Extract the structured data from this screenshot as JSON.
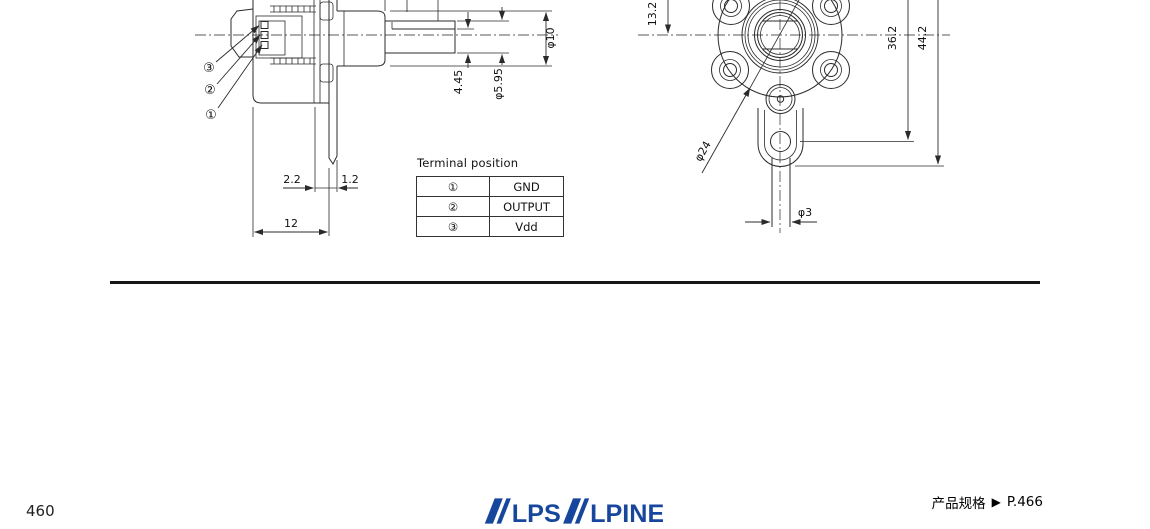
{
  "page": {
    "page_number": "460",
    "footer_right": {
      "label": "产品规格",
      "arrow": "▶",
      "page_ref": "P.466"
    },
    "brand": {
      "logo_text": "ALPSALPINE",
      "logo_color": "#17479d",
      "logo_part_lps": "LPS",
      "logo_part_lpine": "LPINE"
    }
  },
  "terminal_table": {
    "title": "Terminal position",
    "rows": [
      {
        "terminal": "①",
        "signal": "GND"
      },
      {
        "terminal": "②",
        "signal": "OUTPUT"
      },
      {
        "terminal": "③",
        "signal": "Vdd"
      }
    ]
  },
  "drawing": {
    "side_view": {
      "leaders": [
        {
          "label": "③"
        },
        {
          "label": "②"
        },
        {
          "label": "①"
        }
      ],
      "dims": {
        "bushing_dia": "φ10",
        "flat_height": "4.45",
        "shaft_dia": "φ5.95",
        "terminal_offset": "2.2",
        "plate_thickness": "1.2",
        "body_depth": "12"
      }
    },
    "front_view": {
      "dims": {
        "center_height": "13.2",
        "hole_height": "36.2",
        "overall_height": "44.2",
        "body_dia": "φ24",
        "pin_dia": "φ3"
      }
    }
  }
}
